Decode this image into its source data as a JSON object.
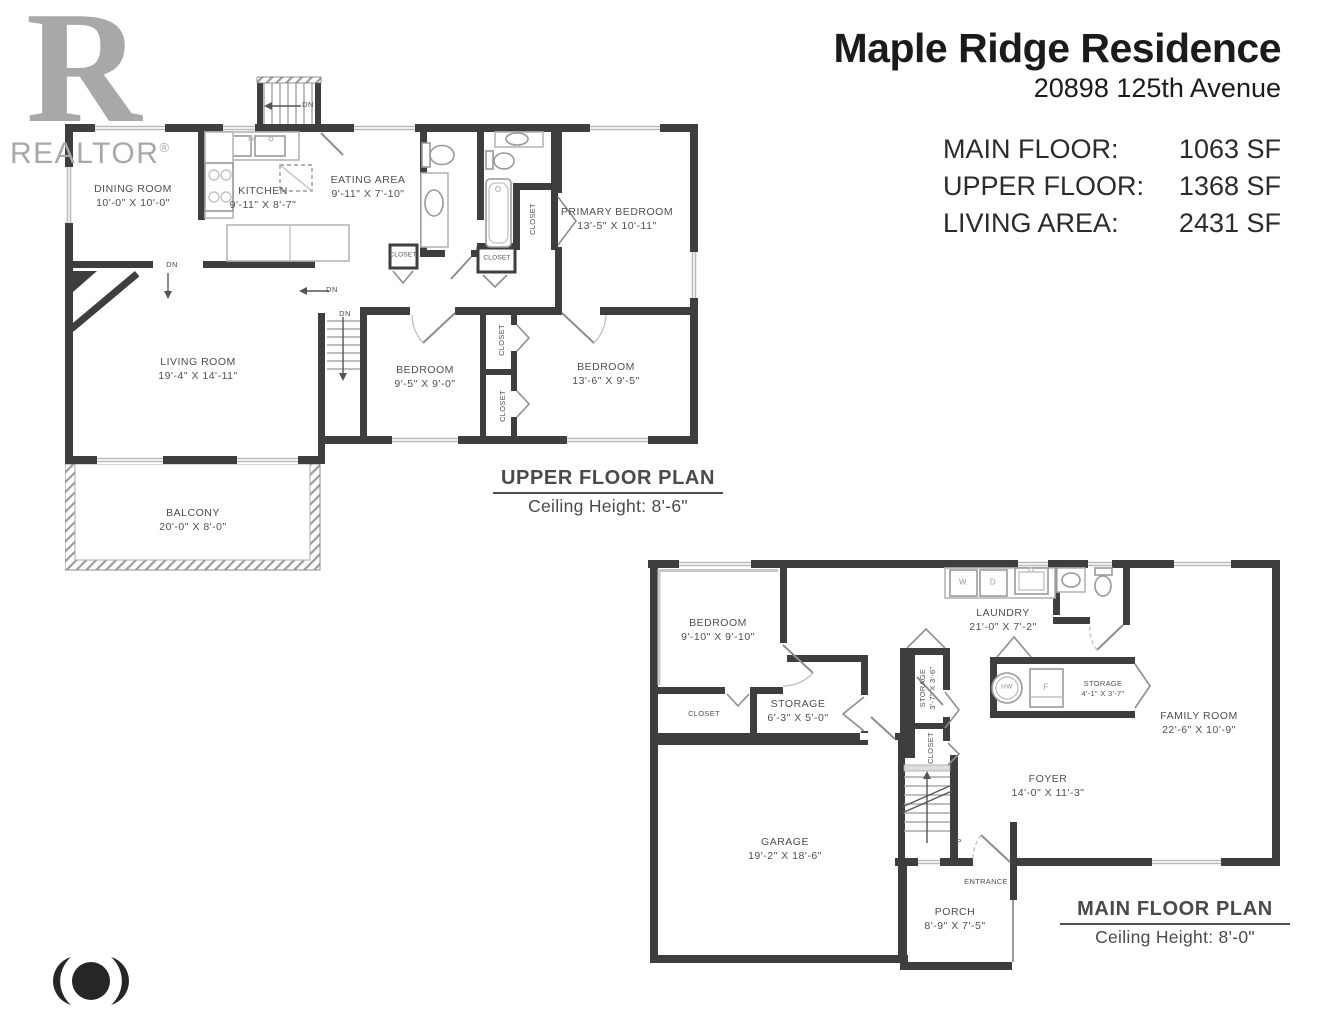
{
  "branding": {
    "realtor_letter": "R",
    "realtor_text": "REALTOR",
    "registered": "®"
  },
  "header": {
    "title": "Maple Ridge Residence",
    "address": "20898 125th Avenue",
    "stats": [
      {
        "label": "MAIN FLOOR:",
        "value": "1063 SF"
      },
      {
        "label": "UPPER FLOOR:",
        "value": "1368 SF"
      },
      {
        "label": "LIVING AREA:",
        "value": "2431 SF"
      }
    ]
  },
  "upper": {
    "caption_title": "UPPER FLOOR PLAN",
    "caption_sub": "Ceiling Height: 8'-6\"",
    "closet_label": "CLOSET",
    "dn_label": "DN",
    "rooms": {
      "dining": {
        "name": "DINING ROOM",
        "dims": "10'-0\" X 10'-0\""
      },
      "kitchen": {
        "name": "KITCHEN",
        "dims": "9'-11\" X 8'-7\""
      },
      "eating": {
        "name": "EATING AREA",
        "dims": "9'-11\" X 7'-10\""
      },
      "primary": {
        "name": "PRIMARY BEDROOM",
        "dims": "13'-5\" X 10'-11\""
      },
      "living": {
        "name": "LIVING ROOM",
        "dims": "19'-4\" X 14'-11\""
      },
      "bedroom1": {
        "name": "BEDROOM",
        "dims": "9'-5\" X 9'-0\""
      },
      "bedroom2": {
        "name": "BEDROOM",
        "dims": "13'-6\" X 9'-5\""
      },
      "balcony": {
        "name": "BALCONY",
        "dims": "20'-0\" X 8'-0\""
      }
    }
  },
  "main": {
    "caption_title": "MAIN FLOOR PLAN",
    "caption_sub": "Ceiling Height: 8'-0\"",
    "closet_label": "CLOSET",
    "up_label": "UP",
    "rooms": {
      "bedroom": {
        "name": "BEDROOM",
        "dims": "9'-10\" X 9'-10\""
      },
      "laundry": {
        "name": "LAUNDRY",
        "dims": "21'-0\" X 7'-2\""
      },
      "storage_small": {
        "name": "STORAGE",
        "dims": "3'-7\" X 3'-6\""
      },
      "storage_mid": {
        "name": "STORAGE",
        "dims": "6'-3\" X 5'-0\""
      },
      "storage_right": {
        "name": "STORAGE",
        "dims": "4'-1\" X 3'-7\""
      },
      "family": {
        "name": "FAMILY ROOM",
        "dims": "22'-6\" X 10'-9\""
      },
      "foyer": {
        "name": "FOYER",
        "dims": "14'-0\" X 11'-3\""
      },
      "garage": {
        "name": "GARAGE",
        "dims": "19'-2\" X 18'-6\""
      },
      "porch": {
        "name": "PORCH",
        "dims": "8'-9\" X 7'-5\""
      },
      "entrance": {
        "name": "ENTRANCE"
      }
    },
    "fixtures": {
      "washer": "W",
      "dryer": "D",
      "hot_water": "HW",
      "furnace": "F"
    }
  }
}
